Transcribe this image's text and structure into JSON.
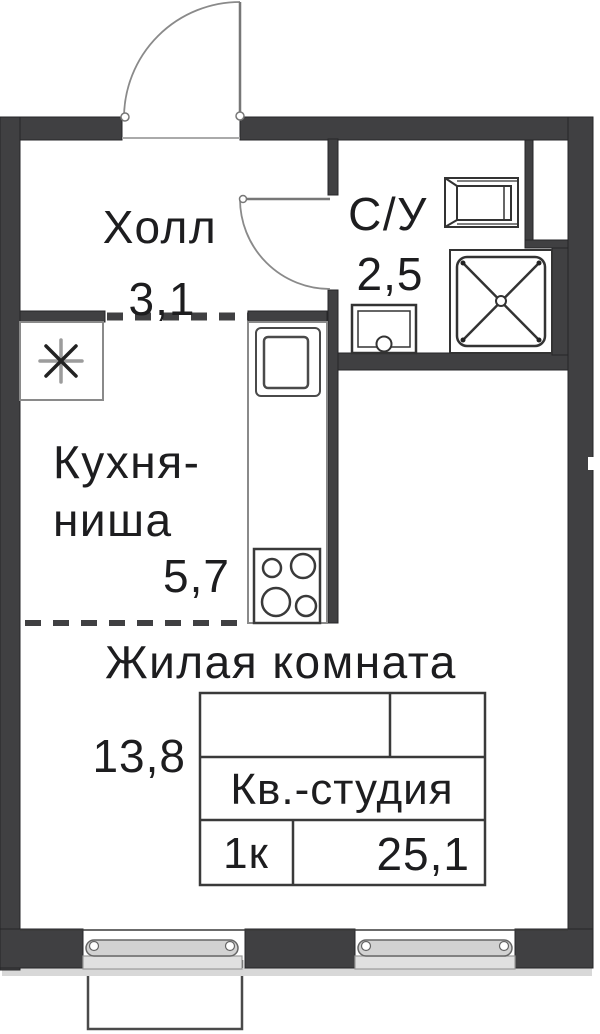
{
  "plan_title": "Studio apartment floor plan",
  "rooms": {
    "hall": {
      "name": "Холл",
      "area": "3,1"
    },
    "bathroom": {
      "name": "С/У",
      "area": "2,5"
    },
    "kitchen": {
      "name_line1": "Кухня-",
      "name_line2": "ниша",
      "area": "5,7"
    },
    "living": {
      "name": "Жилая комната",
      "area": "13,8"
    }
  },
  "summary_table": {
    "apartment_type": "Кв.-студия",
    "rooms_count": "1к",
    "total_area": "25,1"
  },
  "colors": {
    "wall": "#404042",
    "line": "#3a3a3a",
    "fixture_line": "#333333",
    "door_line": "#8a8a8a",
    "window_fill": "#d2d2d2",
    "sill_fill": "#e0e0e0",
    "text": "#1d1d1f"
  }
}
